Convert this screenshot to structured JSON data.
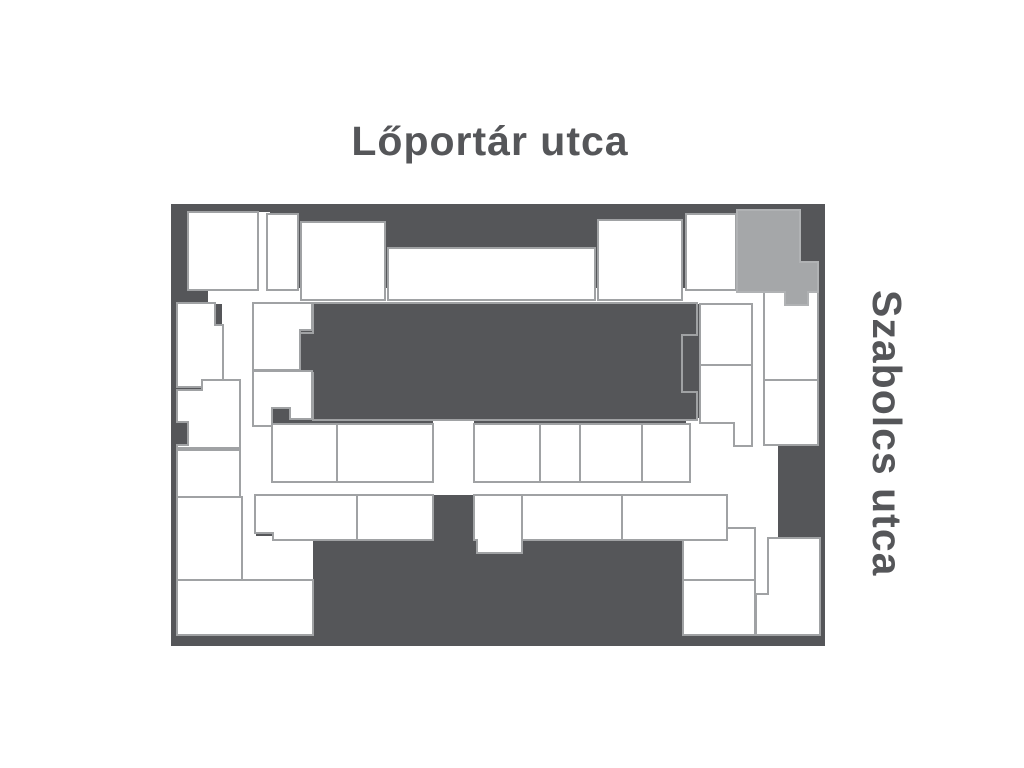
{
  "labels": {
    "top_street": "Lőportár utca",
    "right_street": "Szabolcs utca"
  },
  "colors": {
    "background": "#ffffff",
    "dark": "#555659",
    "unit_fill": "#ffffff",
    "unit_stroke": "#a0a2a4",
    "block_stroke": "#a0a2a4",
    "highlight_fill": "#a5a7a9",
    "highlight_stroke": "#b0b2b4",
    "text": "#555659"
  },
  "floorplan": {
    "plan_rect": {
      "x": 171,
      "y": 204,
      "w": 654,
      "h": 442
    },
    "corridors": [
      {
        "id": "corridor-top",
        "points": [
          [
            208,
            288
          ],
          [
            765,
            288
          ],
          [
            765,
            304
          ],
          [
            208,
            304
          ]
        ]
      },
      {
        "id": "corridor-west",
        "points": [
          [
            222,
            302
          ],
          [
            256,
            302
          ],
          [
            256,
            582
          ],
          [
            222,
            582
          ]
        ]
      },
      {
        "id": "corridor-middle",
        "points": [
          [
            240,
            480
          ],
          [
            728,
            480
          ],
          [
            728,
            495
          ],
          [
            240,
            495
          ]
        ]
      },
      {
        "id": "corridor-center",
        "points": [
          [
            433,
            420
          ],
          [
            474,
            420
          ],
          [
            474,
            495
          ],
          [
            433,
            495
          ]
        ]
      },
      {
        "id": "corridor-open-east",
        "points": [
          [
            686,
            418
          ],
          [
            778,
            418
          ],
          [
            778,
            538
          ],
          [
            686,
            538
          ]
        ]
      },
      {
        "id": "corridor-east-upper",
        "points": [
          [
            751,
            290
          ],
          [
            766,
            290
          ],
          [
            766,
            452
          ],
          [
            751,
            452
          ]
        ]
      },
      {
        "id": "corridor-east-lower",
        "points": [
          [
            751,
            536
          ],
          [
            768,
            536
          ],
          [
            768,
            596
          ],
          [
            751,
            596
          ]
        ]
      },
      {
        "id": "corridor-top-gap",
        "points": [
          [
            256,
            212
          ],
          [
            270,
            212
          ],
          [
            270,
            292
          ],
          [
            256,
            292
          ]
        ]
      },
      {
        "id": "corridor-left-bottom",
        "points": [
          [
            242,
            536
          ],
          [
            315,
            536
          ],
          [
            315,
            580
          ],
          [
            242,
            580
          ]
        ]
      },
      {
        "id": "corridor-row1-left",
        "points": [
          [
            253,
            424
          ],
          [
            274,
            424
          ],
          [
            274,
            482
          ],
          [
            253,
            482
          ]
        ]
      }
    ],
    "dark_features": [
      {
        "id": "courtyard-block",
        "stroke": true,
        "points": [
          [
            313,
            303
          ],
          [
            697,
            303
          ],
          [
            697,
            335
          ],
          [
            682,
            335
          ],
          [
            682,
            392
          ],
          [
            697,
            392
          ],
          [
            697,
            420
          ],
          [
            313,
            420
          ],
          [
            313,
            373
          ],
          [
            300,
            373
          ],
          [
            300,
            333
          ],
          [
            313,
            333
          ]
        ]
      },
      {
        "id": "south-building-mass",
        "stroke": false,
        "points": [
          [
            313,
            538
          ],
          [
            433,
            538
          ],
          [
            433,
            495
          ],
          [
            472,
            495
          ],
          [
            472,
            538
          ],
          [
            683,
            538
          ],
          [
            683,
            635
          ],
          [
            313,
            635
          ]
        ]
      },
      {
        "id": "east-dark-chunk",
        "stroke": false,
        "points": [
          [
            778,
            445
          ],
          [
            818,
            445
          ],
          [
            818,
            537
          ],
          [
            778,
            537
          ]
        ]
      },
      {
        "id": "west-border-bump-top",
        "stroke": false,
        "points": [
          [
            171,
            205
          ],
          [
            188,
            205
          ],
          [
            188,
            277
          ],
          [
            198,
            277
          ],
          [
            198,
            303
          ],
          [
            171,
            303
          ]
        ]
      },
      {
        "id": "west-border-bump-mid",
        "stroke": false,
        "points": [
          [
            171,
            420
          ],
          [
            188,
            420
          ],
          [
            188,
            447
          ],
          [
            171,
            447
          ]
        ]
      }
    ],
    "units": [
      {
        "id": "unit-n1",
        "points": [
          [
            188,
            212
          ],
          [
            258,
            212
          ],
          [
            258,
            290
          ],
          [
            188,
            290
          ]
        ]
      },
      {
        "id": "unit-n2",
        "points": [
          [
            267,
            214
          ],
          [
            298,
            214
          ],
          [
            298,
            290
          ],
          [
            267,
            290
          ]
        ]
      },
      {
        "id": "unit-n3",
        "points": [
          [
            301,
            222
          ],
          [
            385,
            222
          ],
          [
            385,
            300
          ],
          [
            301,
            300
          ]
        ]
      },
      {
        "id": "unit-n4",
        "points": [
          [
            388,
            248
          ],
          [
            595,
            248
          ],
          [
            595,
            300
          ],
          [
            388,
            300
          ]
        ]
      },
      {
        "id": "unit-n5",
        "points": [
          [
            598,
            220
          ],
          [
            682,
            220
          ],
          [
            682,
            300
          ],
          [
            598,
            300
          ]
        ]
      },
      {
        "id": "unit-n6",
        "points": [
          [
            686,
            214
          ],
          [
            736,
            214
          ],
          [
            736,
            290
          ],
          [
            686,
            290
          ]
        ]
      },
      {
        "id": "unit-m1",
        "points": [
          [
            700,
            304
          ],
          [
            752,
            304
          ],
          [
            752,
            365
          ],
          [
            700,
            365
          ]
        ]
      },
      {
        "id": "unit-m2",
        "points": [
          [
            700,
            365
          ],
          [
            752,
            365
          ],
          [
            752,
            446
          ],
          [
            734,
            446
          ],
          [
            734,
            423
          ],
          [
            700,
            423
          ]
        ]
      },
      {
        "id": "unit-e1",
        "points": [
          [
            764,
            292
          ],
          [
            818,
            292
          ],
          [
            818,
            380
          ],
          [
            764,
            380
          ]
        ]
      },
      {
        "id": "unit-e2",
        "points": [
          [
            764,
            380
          ],
          [
            818,
            380
          ],
          [
            818,
            445
          ],
          [
            764,
            445
          ]
        ]
      },
      {
        "id": "unit-e3",
        "points": [
          [
            768,
            538
          ],
          [
            820,
            538
          ],
          [
            820,
            635
          ],
          [
            756,
            635
          ],
          [
            756,
            594
          ],
          [
            768,
            594
          ]
        ]
      },
      {
        "id": "unit-w1",
        "points": [
          [
            177,
            303
          ],
          [
            215,
            303
          ],
          [
            215,
            325
          ],
          [
            223,
            325
          ],
          [
            223,
            387
          ],
          [
            177,
            387
          ]
        ]
      },
      {
        "id": "unit-w2",
        "points": [
          [
            202,
            380
          ],
          [
            240,
            380
          ],
          [
            240,
            448
          ],
          [
            177,
            448
          ],
          [
            177,
            445
          ],
          [
            188,
            445
          ],
          [
            188,
            422
          ],
          [
            177,
            422
          ],
          [
            177,
            390
          ],
          [
            202,
            390
          ]
        ]
      },
      {
        "id": "unit-w3",
        "points": [
          [
            177,
            450
          ],
          [
            240,
            450
          ],
          [
            240,
            497
          ],
          [
            177,
            497
          ]
        ]
      },
      {
        "id": "unit-w4",
        "points": [
          [
            177,
            497
          ],
          [
            242,
            497
          ],
          [
            242,
            580
          ],
          [
            177,
            580
          ]
        ]
      },
      {
        "id": "unit-w5",
        "points": [
          [
            177,
            580
          ],
          [
            313,
            580
          ],
          [
            313,
            635
          ],
          [
            177,
            635
          ]
        ]
      },
      {
        "id": "unit-c1",
        "points": [
          [
            253,
            303
          ],
          [
            312,
            303
          ],
          [
            312,
            330
          ],
          [
            300,
            330
          ],
          [
            300,
            370
          ],
          [
            253,
            370
          ]
        ]
      },
      {
        "id": "unit-c2",
        "points": [
          [
            253,
            371
          ],
          [
            312,
            371
          ],
          [
            312,
            419
          ],
          [
            290,
            419
          ],
          [
            290,
            408
          ],
          [
            272,
            408
          ],
          [
            272,
            426
          ],
          [
            253,
            426
          ]
        ]
      },
      {
        "id": "unit-r1",
        "points": [
          [
            272,
            424
          ],
          [
            337,
            424
          ],
          [
            337,
            482
          ],
          [
            272,
            482
          ]
        ]
      },
      {
        "id": "unit-r2",
        "points": [
          [
            337,
            424
          ],
          [
            433,
            424
          ],
          [
            433,
            482
          ],
          [
            337,
            482
          ]
        ]
      },
      {
        "id": "unit-r3",
        "points": [
          [
            474,
            424
          ],
          [
            540,
            424
          ],
          [
            540,
            482
          ],
          [
            474,
            482
          ]
        ]
      },
      {
        "id": "unit-r4",
        "points": [
          [
            540,
            424
          ],
          [
            580,
            424
          ],
          [
            580,
            482
          ],
          [
            540,
            482
          ]
        ]
      },
      {
        "id": "unit-r5",
        "points": [
          [
            580,
            424
          ],
          [
            642,
            424
          ],
          [
            642,
            482
          ],
          [
            580,
            482
          ]
        ]
      },
      {
        "id": "unit-r6",
        "points": [
          [
            642,
            424
          ],
          [
            690,
            424
          ],
          [
            690,
            482
          ],
          [
            642,
            482
          ]
        ]
      },
      {
        "id": "unit-s1",
        "points": [
          [
            255,
            495
          ],
          [
            357,
            495
          ],
          [
            357,
            540
          ],
          [
            273,
            540
          ],
          [
            273,
            533
          ],
          [
            255,
            533
          ]
        ]
      },
      {
        "id": "unit-s2",
        "points": [
          [
            357,
            495
          ],
          [
            433,
            495
          ],
          [
            433,
            540
          ],
          [
            357,
            540
          ]
        ]
      },
      {
        "id": "unit-s3",
        "points": [
          [
            474,
            495
          ],
          [
            522,
            495
          ],
          [
            522,
            553
          ],
          [
            477,
            553
          ],
          [
            477,
            540
          ],
          [
            474,
            540
          ]
        ]
      },
      {
        "id": "unit-s4",
        "points": [
          [
            522,
            495
          ],
          [
            622,
            495
          ],
          [
            622,
            540
          ],
          [
            522,
            540
          ]
        ]
      },
      {
        "id": "unit-s5",
        "points": [
          [
            622,
            495
          ],
          [
            727,
            495
          ],
          [
            727,
            540
          ],
          [
            622,
            540
          ]
        ]
      },
      {
        "id": "unit-b1",
        "points": [
          [
            727,
            528
          ],
          [
            755,
            528
          ],
          [
            755,
            580
          ],
          [
            683,
            580
          ],
          [
            683,
            540
          ],
          [
            727,
            540
          ]
        ]
      },
      {
        "id": "unit-b2",
        "points": [
          [
            683,
            580
          ],
          [
            755,
            580
          ],
          [
            755,
            635
          ],
          [
            683,
            635
          ]
        ]
      }
    ],
    "highlight_unit": {
      "id": "unit-highlighted",
      "points": [
        [
          737,
          210
        ],
        [
          800,
          210
        ],
        [
          800,
          262
        ],
        [
          818,
          262
        ],
        [
          818,
          292
        ],
        [
          808,
          292
        ],
        [
          808,
          305
        ],
        [
          785,
          305
        ],
        [
          785,
          292
        ],
        [
          737,
          292
        ]
      ]
    }
  }
}
